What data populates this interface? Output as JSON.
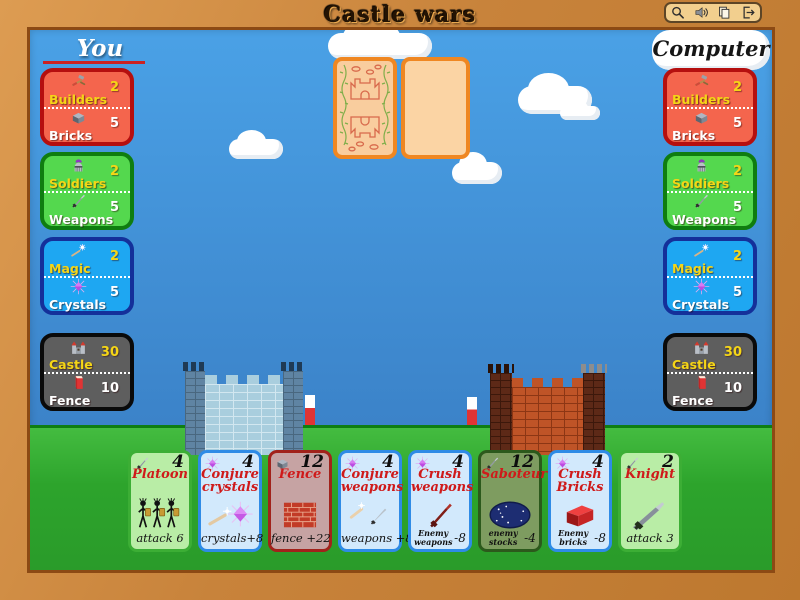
{
  "window": {
    "title": "Castle wars"
  },
  "toolbar": {
    "icons": [
      "magnifier",
      "speaker",
      "pages",
      "exit"
    ]
  },
  "players": {
    "you": {
      "label": "You",
      "panels": [
        {
          "type": "bricks",
          "rows": [
            {
              "icon": "hammer",
              "label": "Builders",
              "value": "2"
            },
            {
              "icon": "brick",
              "label": "Bricks",
              "value": "5"
            }
          ]
        },
        {
          "type": "weapons",
          "rows": [
            {
              "icon": "helmet",
              "label": "Soldiers",
              "value": "2"
            },
            {
              "icon": "sword",
              "label": "Weapons",
              "value": "5"
            }
          ]
        },
        {
          "type": "magic",
          "rows": [
            {
              "icon": "wand",
              "label": "Magic",
              "value": "2"
            },
            {
              "icon": "crystal",
              "label": "Crystals",
              "value": "5"
            }
          ]
        },
        {
          "type": "castle",
          "rows": [
            {
              "icon": "castle",
              "label": "Castle",
              "value": "30"
            },
            {
              "icon": "fence",
              "label": "Fence",
              "value": "10"
            }
          ]
        }
      ]
    },
    "computer": {
      "label": "Computer",
      "panels": [
        {
          "type": "bricks",
          "rows": [
            {
              "icon": "hammer",
              "label": "Builders",
              "value": "2"
            },
            {
              "icon": "brick",
              "label": "Bricks",
              "value": "5"
            }
          ]
        },
        {
          "type": "weapons",
          "rows": [
            {
              "icon": "helmet",
              "label": "Soldiers",
              "value": "2"
            },
            {
              "icon": "sword",
              "label": "Weapons",
              "value": "5"
            }
          ]
        },
        {
          "type": "magic",
          "rows": [
            {
              "icon": "wand",
              "label": "Magic",
              "value": "2"
            },
            {
              "icon": "crystal",
              "label": "Crystals",
              "value": "5"
            }
          ]
        },
        {
          "type": "castle",
          "rows": [
            {
              "icon": "castle",
              "label": "Castle",
              "value": "30"
            },
            {
              "icon": "fence",
              "label": "Fence",
              "value": "10"
            }
          ]
        }
      ]
    }
  },
  "center": {
    "deck_card": "card-back-castle-pattern",
    "discard_slot": "empty"
  },
  "hand": {
    "cards": [
      {
        "type": "attack",
        "icon": "sword",
        "cost": "4",
        "title": "Platoon",
        "art": "platoon",
        "caption": "attack 6"
      },
      {
        "type": "magic",
        "icon": "crystal",
        "cost": "4",
        "title": "Conjure crystals",
        "art": "conjure-crystals",
        "caption": "crystals+8"
      },
      {
        "type": "brick",
        "icon": "brick",
        "cost": "12",
        "title": "Fence",
        "art": "brick-wall",
        "caption": "fence +22"
      },
      {
        "type": "magic",
        "icon": "crystal",
        "cost": "4",
        "title": "Conjure weapons",
        "art": "wand-sword",
        "caption": "weapons +8"
      },
      {
        "type": "magic",
        "icon": "crystal",
        "cost": "4",
        "title": "Crush weapons",
        "art": "red-sword",
        "caption_main": "Enemy weapons",
        "caption_value": "-8"
      },
      {
        "type": "sabotage",
        "icon": "sword",
        "cost": "12",
        "title": "Saboteur",
        "art": "night-moon",
        "caption_main": "enemy stocks",
        "caption_value": "-4"
      },
      {
        "type": "magic",
        "icon": "crystal",
        "cost": "4",
        "title": "Crush Bricks",
        "art": "red-brick",
        "caption_main": "Enemy bricks",
        "caption_value": "-8"
      },
      {
        "type": "attack",
        "icon": "sword",
        "cost": "2",
        "title": "Knight",
        "art": "sword-large",
        "caption": "attack 3"
      }
    ]
  },
  "colors": {
    "frame": "#c8833b",
    "sky_top": "#4aa1e6",
    "sky_bottom": "#3b82c8",
    "grass": "#2da42c",
    "panel_bricks": "#f4654d",
    "panel_weapons": "#54d84e",
    "panel_magic": "#1ea7f2",
    "panel_castle": "#5e5e5e",
    "card_attack_bg": "#b9eda6",
    "card_attack_border": "#3cae35",
    "card_magic_bg": "#d2e9fc",
    "card_magic_border": "#2e8be6",
    "card_brick_bg": "#c6a3a3",
    "card_brick_border": "#a1221b",
    "card_sabotage_bg": "#7e9c60",
    "card_sabotage_border": "#2c591c",
    "label_yellow": "#f5d616",
    "label_white": "#ffffff",
    "title_red": "#cf1a1a",
    "underline_red": "#cc2222"
  }
}
